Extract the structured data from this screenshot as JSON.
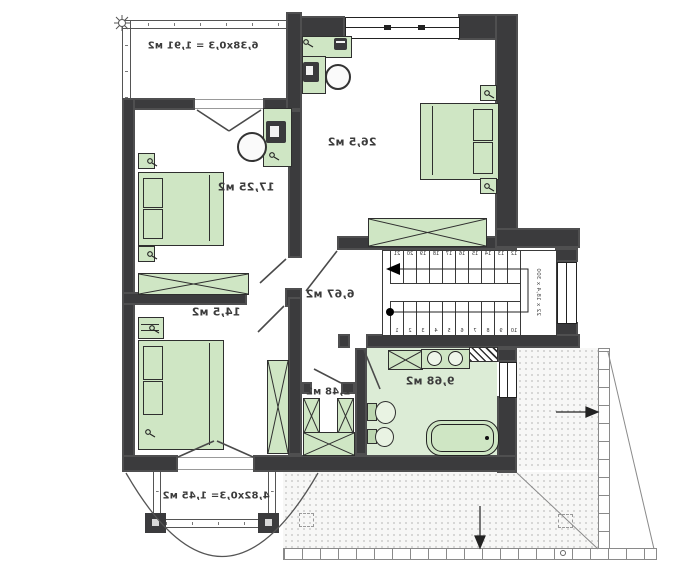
{
  "plan": {
    "balcony_top_label": "6,38x0,3 = 1,91 м2",
    "bedroom_large_label": "26,5 м2",
    "bedroom_mid_label": "17,25 м2",
    "bedroom_low_label": "14,5 м2",
    "hall_label": "6,67 м2",
    "closet_label": "2,48 м2",
    "bath_label": "9,68 м2",
    "balcony_bottom_label": "4,82x0,3= 1,45 м2"
  },
  "stairs": {
    "dimension_label": "22 x 18,4 x 300",
    "upper_steps": [
      "21",
      "20",
      "19",
      "18",
      "17",
      "16",
      "15",
      "14",
      "13",
      "12"
    ],
    "lower_steps": [
      "1",
      "2",
      "3",
      "4",
      "5",
      "6",
      "7",
      "8",
      "9",
      "10"
    ]
  },
  "colors": {
    "wall": "#3b3b3d",
    "furniture_fill": "#cfe6c4",
    "furniture_line": "#2f2f2f",
    "bath_floor": "#dcecd6",
    "terrace_dot": "#cccccc"
  }
}
